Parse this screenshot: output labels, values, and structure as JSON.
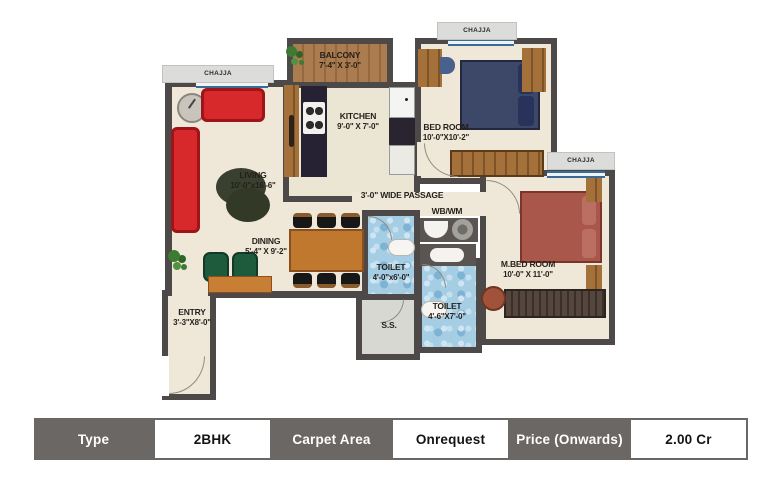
{
  "plan": {
    "rooms": {
      "living": {
        "name": "LIVING",
        "dims": "10'-0\"x16'-6\""
      },
      "dining": {
        "name": "DINING",
        "dims": "5'-4\" X 9'-2\""
      },
      "kitchen": {
        "name": "KITCHEN",
        "dims": "9'-0\" X 7'-0\""
      },
      "balcony": {
        "name": "BALCONY",
        "dims": "7'-4\" X 3'-0\""
      },
      "bedroom": {
        "name": "BED ROOM",
        "dims": "10'-0\"X10'-2\""
      },
      "master_bedroom": {
        "name": "M.BED ROOM",
        "dims": "10'-0\" X 11'-0\""
      },
      "toilet_common": {
        "name": "TOILET",
        "dims": "4'-0\"x6'-0\""
      },
      "toilet_master": {
        "name": "TOILET",
        "dims": "4'-6\"X7'-0\""
      },
      "entry": {
        "name": "ENTRY",
        "dims": "3'-3\"X8'-0\""
      },
      "utility": {
        "name": "S.S."
      },
      "passage": {
        "name": "3'-0\" WIDE PASSAGE"
      },
      "wash_area": {
        "name": "WB/WM"
      }
    },
    "chajja": {
      "top_left": "CHAJJA",
      "top_right": "CHAJJA",
      "right": "CHAJJA"
    },
    "colors": {
      "wall": "#4d4948",
      "floor": "#efe8d8",
      "toilet_tile": "#a5cee4",
      "sofa_red": "#d7282c",
      "table_header": "#6b6765"
    }
  },
  "spec_table": {
    "type_label": "Type",
    "type_value": "2BHK",
    "carpet_label": "Carpet  Area",
    "carpet_value": "Onrequest",
    "price_label": "Price (Onwards)",
    "price_value": "2.00 Cr"
  }
}
